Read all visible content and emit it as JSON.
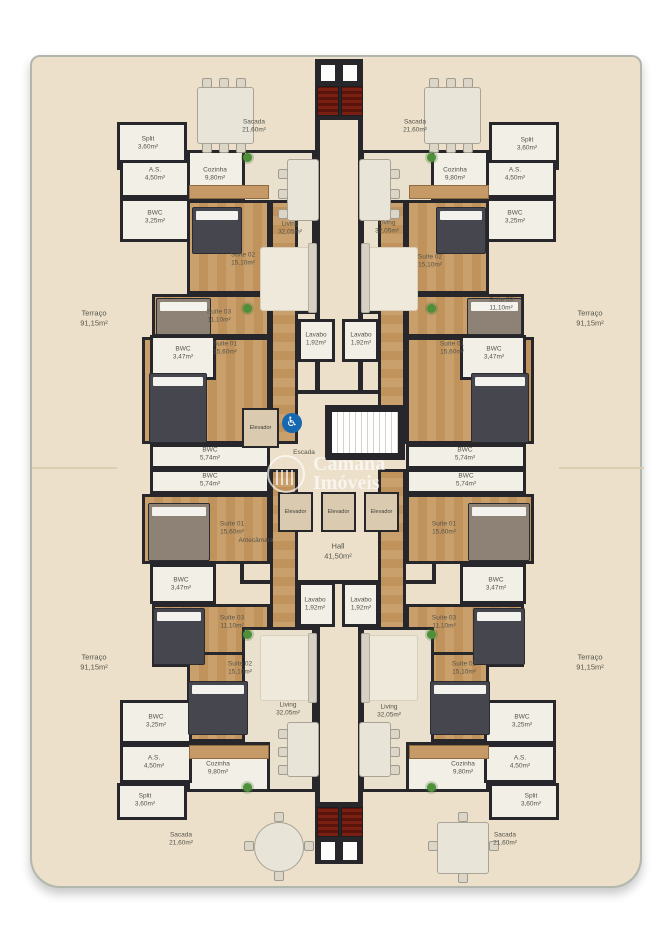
{
  "watermark": {
    "line1": "Camana",
    "line2": "Imóveis"
  },
  "terrace": {
    "name": "Terraço",
    "area": "91,15m²"
  },
  "rooms": {
    "sacada": {
      "name": "Sacada",
      "area": "21,60m²"
    },
    "split": {
      "name": "Split",
      "area": "3,60m²"
    },
    "servico": {
      "name": "A.S.",
      "area": "4,50m²"
    },
    "cozinha": {
      "name": "Cozinha",
      "area": "9,80m²"
    },
    "bwc_social": {
      "name": "BWC",
      "area": "3,25m²"
    },
    "living": {
      "name": "Living",
      "area": "32,05m²"
    },
    "suite01": {
      "name": "Suíte 01",
      "area": "15,60m²"
    },
    "suite02": {
      "name": "Suíte 02",
      "area": "15,10m²"
    },
    "suite03": {
      "name": "Suíte 03",
      "area": "11,10m²"
    },
    "bwc_suite": {
      "name": "BWC",
      "area": "3,47m²"
    },
    "bwc": {
      "name": "BWC",
      "area": "5,74m²"
    },
    "lavabo": {
      "name": "Lavabo",
      "area": "1,92m²"
    }
  },
  "core": {
    "elevador": "Elevador",
    "escada": "Escada",
    "antecamara": "Antecâmara",
    "hall_name": "Hall",
    "hall_area": "41,50m²",
    "accessible_symbol": "♿"
  },
  "colors": {
    "plan_bg": "#ece0cb",
    "wall": "#27272b",
    "wood": "#c9a06c",
    "grill_red": "#6d1a0f",
    "accessible_blue": "#1768b0"
  }
}
